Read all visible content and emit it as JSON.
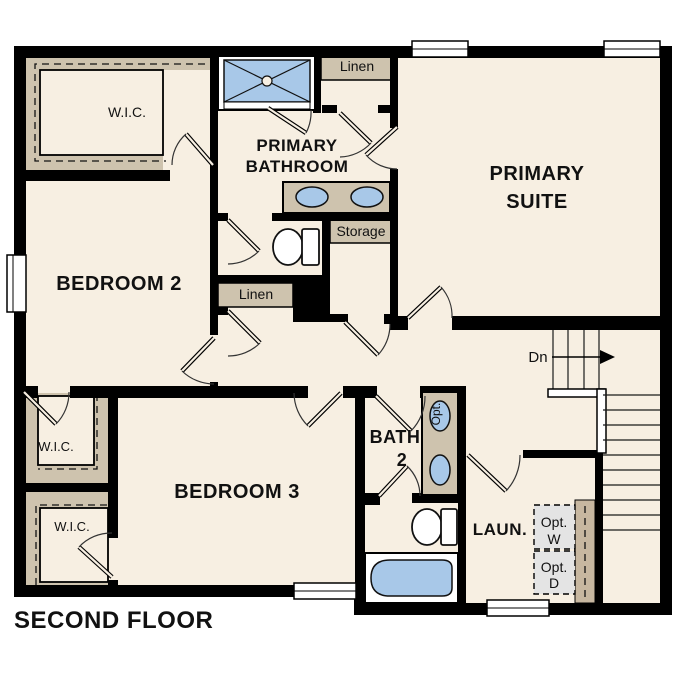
{
  "floor_title": "SECOND FLOOR",
  "rooms": {
    "primary_suite": {
      "line1": "PRIMARY",
      "line2": "SUITE"
    },
    "primary_bathroom": {
      "line1": "PRIMARY",
      "line2": "BATHROOM"
    },
    "bedroom_2": {
      "label": "BEDROOM 2"
    },
    "bedroom_3": {
      "label": "BEDROOM 3"
    },
    "bath_2": {
      "line1": "BATH",
      "line2": "2"
    },
    "laundry": {
      "label": "LAUN."
    }
  },
  "closets": {
    "wic_top_left": {
      "label": "W.I.C."
    },
    "wic_middle": {
      "label": "W.I.C."
    },
    "wic_bottom": {
      "label": "W.I.C."
    },
    "linen_top": {
      "label": "Linen"
    },
    "linen_middle": {
      "label": "Linen"
    },
    "storage": {
      "label": "Storage"
    }
  },
  "stairs": {
    "direction_label": "Dn"
  },
  "fixtures": {
    "optional_sink_label": "Opt.",
    "optional_washer": {
      "line1": "Opt.",
      "line2": "W"
    },
    "optional_dryer": {
      "line1": "Opt.",
      "line2": "D"
    }
  },
  "colors": {
    "floor": "#f7efe2",
    "closet_shelf": "#cec3ae",
    "fixture_blue": "#a8c8e8",
    "wall": "#000000",
    "optional_appliance_fill": "#e4e4e4"
  }
}
